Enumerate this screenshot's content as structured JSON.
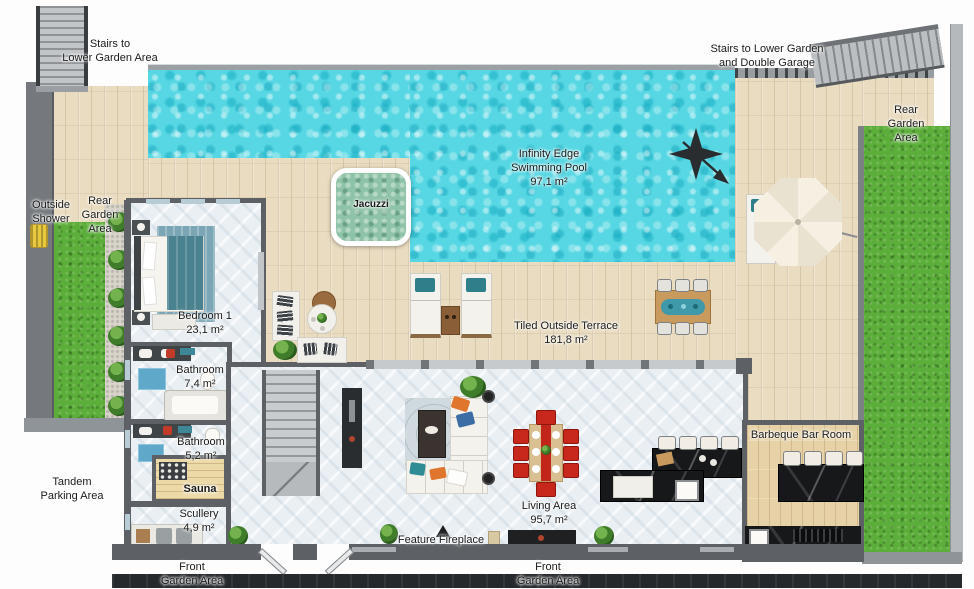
{
  "meta": {
    "title": "Villa ground floor plan with infinity pool",
    "canvas_px": "974x588"
  },
  "colors": {
    "pool_water": "#56d7e3",
    "jacuzzi_water": "#8fc3a7",
    "wood_deck": "#e9dcc0",
    "grass": "#5cae3a",
    "wall": "#5d6165",
    "interior_tile": "#e9eff3",
    "dining_chair_red": "#c8281c",
    "black_marble": "#17181a",
    "shower_yellow": "#e8c93e",
    "umbrella": "#f5efe2",
    "compass": "#2a2d2f"
  },
  "icons": {
    "compass": "north-arrow-compass",
    "umbrella": "parasol-octagon",
    "shower": "outdoor-shower-fixture"
  },
  "labels": {
    "stairs_top_left": {
      "lines": [
        "Stairs to",
        "Lower Garden Area"
      ]
    },
    "stairs_top_right": {
      "lines": [
        "Stairs to Lower Garden",
        "and Double Garage"
      ]
    },
    "rear_garden_right": {
      "lines": [
        "Rear",
        "Garden Area"
      ]
    },
    "pool": {
      "lines": [
        "Infinity Edge",
        "Swimming Pool",
        "97,1 m²"
      ]
    },
    "jacuzzi": {
      "lines": [
        "Jacuzzi"
      ]
    },
    "outside_shower": {
      "lines": [
        "Outside",
        "Shower"
      ]
    },
    "rear_garden_left": {
      "lines": [
        "Rear",
        "Garden Area"
      ]
    },
    "bedroom1": {
      "lines": [
        "Bedroom 1",
        "23,1 m²"
      ]
    },
    "bathroom1": {
      "lines": [
        "Bathroom",
        "7,4 m²"
      ]
    },
    "bathroom2": {
      "lines": [
        "Bathroom",
        "5,2 m²"
      ]
    },
    "sauna": {
      "lines": [
        "Sauna"
      ]
    },
    "scullery": {
      "lines": [
        "Scullery",
        "4,9 m²"
      ]
    },
    "tandem_parking": {
      "lines": [
        "Tandem",
        "Parking Area"
      ]
    },
    "terrace": {
      "lines": [
        "Tiled Outside Terrace",
        "181,8 m²"
      ]
    },
    "living": {
      "lines": [
        "Living Area",
        "95,7 m²"
      ]
    },
    "fireplace": {
      "lines": [
        "Feature Fireplace"
      ]
    },
    "barbeque": {
      "lines": [
        "Barbeque Bar Room"
      ]
    },
    "front_garden_left": {
      "lines": [
        "Front",
        "Garden Area"
      ]
    },
    "front_garden_center": {
      "lines": [
        "Front",
        "Garden Area"
      ]
    }
  },
  "rooms": [
    {
      "name": "Infinity Edge Swimming Pool",
      "area": "97,1 m²"
    },
    {
      "name": "Jacuzzi",
      "area": ""
    },
    {
      "name": "Bedroom 1",
      "area": "23,1 m²"
    },
    {
      "name": "Bathroom",
      "area": "7,4 m²"
    },
    {
      "name": "Bathroom",
      "area": "5,2 m²"
    },
    {
      "name": "Sauna",
      "area": ""
    },
    {
      "name": "Scullery",
      "area": "4,9 m²"
    },
    {
      "name": "Living Area",
      "area": "95,7 m²"
    },
    {
      "name": "Tiled Outside Terrace",
      "area": "181,8 m²"
    },
    {
      "name": "Barbeque Bar Room",
      "area": ""
    }
  ]
}
